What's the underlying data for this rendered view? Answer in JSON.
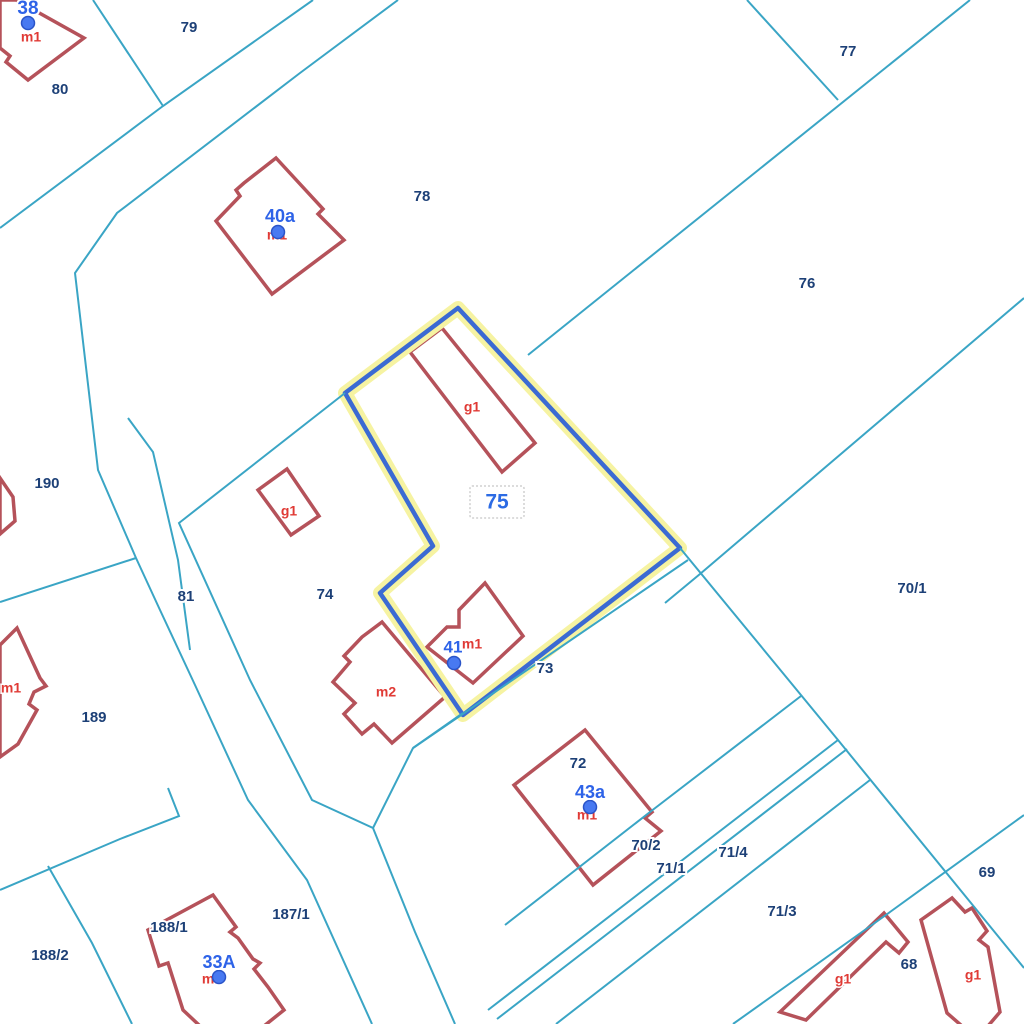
{
  "map": {
    "kind": "cadastral-parcel-map",
    "colors": {
      "background": "#ffffff",
      "boundary_line": "#3aa5c5",
      "building_outline": "#b5525a",
      "building_fill": "#ffffff",
      "selected_halo": "#f6f3a2",
      "selected_stroke": "#3b6ad3",
      "parcel_label": "#1d4077",
      "selected_label": "#2c6be4",
      "address_label": "#2e63e8",
      "building_type_label": "#e03a35",
      "address_dot_fill": "#4879f1",
      "address_dot_ring": "#2a54c8",
      "selection_box_border": "#b9b9b9"
    },
    "selected_parcel": {
      "number": "75",
      "label_pos": [
        497,
        503
      ],
      "label_size": 21,
      "label_box": [
        470,
        486,
        54,
        32
      ],
      "polygon": [
        [
          458,
          308
        ],
        [
          680,
          548
        ],
        [
          463,
          715
        ],
        [
          380,
          593
        ],
        [
          433,
          546
        ],
        [
          345,
          393
        ]
      ]
    },
    "parcels": [
      {
        "number": "79",
        "label_pos": [
          189,
          28
        ]
      },
      {
        "number": "77",
        "label_pos": [
          848,
          52
        ]
      },
      {
        "number": "80",
        "label_pos": [
          60,
          90
        ]
      },
      {
        "number": "78",
        "label_pos": [
          422,
          197
        ]
      },
      {
        "number": "76",
        "label_pos": [
          807,
          284
        ]
      },
      {
        "number": "190",
        "label_pos": [
          47,
          484
        ]
      },
      {
        "number": "70/1",
        "label_pos": [
          912,
          589
        ]
      },
      {
        "number": "81",
        "label_pos": [
          186,
          597
        ]
      },
      {
        "number": "74",
        "label_pos": [
          325,
          595
        ]
      },
      {
        "number": "189",
        "label_pos": [
          94,
          718
        ]
      },
      {
        "number": "73",
        "label_pos": [
          545,
          669
        ]
      },
      {
        "number": "72",
        "label_pos": [
          578,
          764
        ]
      },
      {
        "number": "70/2",
        "label_pos": [
          646,
          846
        ]
      },
      {
        "number": "71/4",
        "label_pos": [
          733,
          853
        ]
      },
      {
        "number": "71/1",
        "label_pos": [
          671,
          869
        ]
      },
      {
        "number": "71/3",
        "label_pos": [
          782,
          912
        ]
      },
      {
        "number": "69",
        "label_pos": [
          987,
          873
        ]
      },
      {
        "number": "68",
        "label_pos": [
          909,
          965
        ]
      },
      {
        "number": "188/1",
        "label_pos": [
          169,
          928
        ]
      },
      {
        "number": "187/1",
        "label_pos": [
          291,
          915
        ]
      },
      {
        "number": "188/2",
        "label_pos": [
          50,
          956
        ]
      }
    ],
    "address_points": [
      {
        "text": "38",
        "label_pos": [
          28,
          9
        ],
        "size": 19,
        "dot": [
          28,
          23
        ]
      },
      {
        "text": "40a",
        "label_pos": [
          280,
          217
        ],
        "size": 18,
        "dot": [
          278,
          232
        ]
      },
      {
        "text": "41",
        "label_pos": [
          453,
          648
        ],
        "size": 17,
        "dot": [
          454,
          663
        ]
      },
      {
        "text": "43a",
        "label_pos": [
          590,
          793
        ],
        "size": 18,
        "dot": [
          590,
          807
        ]
      },
      {
        "text": "33A",
        "label_pos": [
          219,
          963
        ],
        "size": 18,
        "dot": [
          219,
          977
        ]
      }
    ],
    "building_type_labels": [
      {
        "text": "m1",
        "pos": [
          31,
          38
        ]
      },
      {
        "text": "m1",
        "pos": [
          277,
          236
        ]
      },
      {
        "text": "g1",
        "pos": [
          472,
          408
        ]
      },
      {
        "text": "g1",
        "pos": [
          289,
          512
        ]
      },
      {
        "text": "m2",
        "pos": [
          386,
          693
        ]
      },
      {
        "text": "m1",
        "pos": [
          472,
          645
        ]
      },
      {
        "text": "m1",
        "pos": [
          11,
          689
        ]
      },
      {
        "text": "m1",
        "pos": [
          587,
          816
        ]
      },
      {
        "text": "m1",
        "pos": [
          212,
          980
        ]
      },
      {
        "text": "g1",
        "pos": [
          843,
          980
        ]
      },
      {
        "text": "g1",
        "pos": [
          973,
          976
        ]
      }
    ],
    "buildings": [
      [
        [
          16,
          0
        ],
        [
          84,
          38
        ],
        [
          28,
          80
        ],
        [
          6,
          62
        ],
        [
          10,
          56
        ],
        [
          0,
          48
        ],
        [
          0,
          0
        ]
      ],
      [
        [
          276,
          158
        ],
        [
          323,
          209
        ],
        [
          318,
          214
        ],
        [
          344,
          240
        ],
        [
          272,
          294
        ],
        [
          216,
          221
        ],
        [
          240,
          196
        ],
        [
          236,
          190
        ],
        [
          244,
          183
        ]
      ],
      [
        [
          442,
          328
        ],
        [
          410,
          352
        ],
        [
          502,
          472
        ],
        [
          535,
          443
        ]
      ],
      [
        [
          287,
          469
        ],
        [
          319,
          516
        ],
        [
          291,
          535
        ],
        [
          258,
          490
        ]
      ],
      [
        [
          485,
          583
        ],
        [
          523,
          636
        ],
        [
          473,
          683
        ],
        [
          427,
          647
        ],
        [
          447,
          627
        ],
        [
          459,
          627
        ],
        [
          459,
          610
        ]
      ],
      [
        [
          382,
          622
        ],
        [
          445,
          697
        ],
        [
          392,
          743
        ],
        [
          374,
          724
        ],
        [
          362,
          734
        ],
        [
          344,
          714
        ],
        [
          355,
          703
        ],
        [
          333,
          682
        ],
        [
          350,
          662
        ],
        [
          344,
          656
        ],
        [
          362,
          637
        ]
      ],
      [
        [
          585,
          730
        ],
        [
          652,
          812
        ],
        [
          645,
          818
        ],
        [
          661,
          831
        ],
        [
          593,
          885
        ],
        [
          514,
          785
        ]
      ],
      [
        [
          213,
          895
        ],
        [
          236,
          927
        ],
        [
          230,
          932
        ],
        [
          238,
          938
        ],
        [
          253,
          959
        ],
        [
          260,
          963
        ],
        [
          254,
          969
        ],
        [
          268,
          987
        ],
        [
          284,
          1010
        ],
        [
          264,
          1026
        ],
        [
          200,
          1026
        ],
        [
          183,
          1010
        ],
        [
          168,
          963
        ],
        [
          159,
          966
        ],
        [
          148,
          930
        ]
      ],
      [
        [
          780,
          1012
        ],
        [
          884,
          913
        ],
        [
          908,
          942
        ],
        [
          899,
          953
        ],
        [
          886,
          942
        ],
        [
          806,
          1020
        ]
      ],
      [
        [
          952,
          898
        ],
        [
          921,
          920
        ],
        [
          947,
          1013
        ],
        [
          962,
          1026
        ],
        [
          988,
          1026
        ],
        [
          1000,
          1012
        ],
        [
          988,
          947
        ],
        [
          979,
          940
        ],
        [
          987,
          931
        ],
        [
          972,
          908
        ],
        [
          965,
          912
        ]
      ],
      [
        [
          0,
          478
        ],
        [
          13,
          497
        ],
        [
          15,
          521
        ],
        [
          0,
          534
        ]
      ],
      [
        [
          0,
          645
        ],
        [
          17,
          628
        ],
        [
          40,
          678
        ],
        [
          46,
          686
        ],
        [
          34,
          692
        ],
        [
          29,
          704
        ],
        [
          37,
          710
        ],
        [
          18,
          744
        ],
        [
          0,
          757
        ]
      ]
    ],
    "boundary_lines": [
      [
        [
          93,
          0
        ],
        [
          163,
          106
        ]
      ],
      [
        [
          313,
          0
        ],
        [
          163,
          106
        ],
        [
          0,
          228
        ]
      ],
      [
        [
          398,
          0
        ],
        [
          300,
          73
        ],
        [
          117,
          213
        ],
        [
          75,
          273
        ],
        [
          98,
          470
        ],
        [
          136,
          558
        ],
        [
          160,
          610
        ],
        [
          195,
          685
        ],
        [
          248,
          800
        ],
        [
          307,
          880
        ],
        [
          372,
          1024
        ]
      ],
      [
        [
          128,
          418
        ],
        [
          153,
          452
        ],
        [
          178,
          560
        ],
        [
          190,
          650
        ]
      ],
      [
        [
          345,
          393
        ],
        [
          179,
          523
        ],
        [
          250,
          680
        ],
        [
          312,
          800
        ],
        [
          373,
          828
        ],
        [
          415,
          932
        ],
        [
          455,
          1024
        ]
      ],
      [
        [
          0,
          602
        ],
        [
          136,
          558
        ]
      ],
      [
        [
          970,
          0
        ],
        [
          528,
          355
        ]
      ],
      [
        [
          747,
          0
        ],
        [
          838,
          100
        ]
      ],
      [
        [
          1024,
          298
        ],
        [
          700,
          574
        ],
        [
          665,
          603
        ]
      ],
      [
        [
          680,
          548
        ],
        [
          838,
          740
        ],
        [
          1024,
          968
        ]
      ],
      [
        [
          688,
          560
        ],
        [
          413,
          748
        ],
        [
          373,
          828
        ]
      ],
      [
        [
          463,
          713
        ],
        [
          413,
          748
        ]
      ],
      [
        [
          801,
          696
        ],
        [
          650,
          812
        ],
        [
          505,
          925
        ]
      ],
      [
        [
          838,
          740
        ],
        [
          488,
          1010
        ]
      ],
      [
        [
          847,
          749
        ],
        [
          497,
          1019
        ]
      ],
      [
        [
          870,
          780
        ],
        [
          556,
          1024
        ]
      ],
      [
        [
          1024,
          815
        ],
        [
          890,
          912
        ],
        [
          733,
          1024
        ]
      ],
      [
        [
          0,
          890
        ],
        [
          120,
          839
        ],
        [
          179,
          816
        ],
        [
          168,
          788
        ]
      ],
      [
        [
          48,
          866
        ],
        [
          92,
          943
        ],
        [
          132,
          1024
        ]
      ]
    ]
  }
}
